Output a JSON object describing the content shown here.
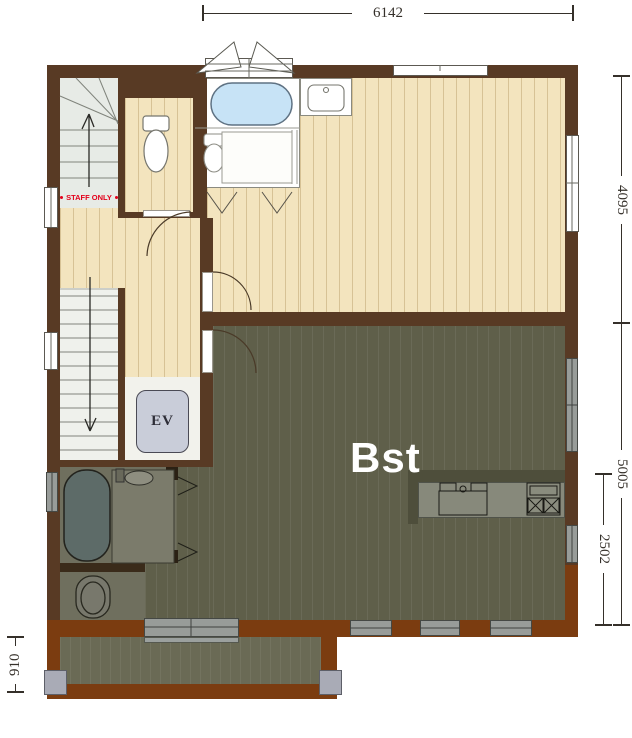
{
  "plan": {
    "labels": {
      "basement_room": "Bst",
      "elevator": "EV",
      "staff_only": "STAFF ONLY"
    },
    "dimensions": {
      "top_width": "6142",
      "right_upper": "4095",
      "right_lower": "5005",
      "right_inner": "2502",
      "left_balcony": "910"
    },
    "colors": {
      "wall_dark": "#583a24",
      "wall_red": "#7b3c10",
      "floor_beige": "#f3e4be",
      "floor_olive": "#5f5f4a",
      "floor_balcony": "#6a6a55",
      "floor_bath": "#6f6f5e",
      "stair_upper": "#e7ebe6",
      "stair_lower": "#eff1ec",
      "ev_hall": "#f2f2ec",
      "tub_blue": "#c7e3f6",
      "tub_dark": "#5d6b68",
      "ev_car": "#c9cdd9",
      "window_gray": "#989c99",
      "counter_gray": "#87897b",
      "pony_wall": "#4e4e3b",
      "column_gray": "#a9abb6",
      "staff_red": "#e3001b",
      "dim_ink": "#35302a"
    }
  }
}
